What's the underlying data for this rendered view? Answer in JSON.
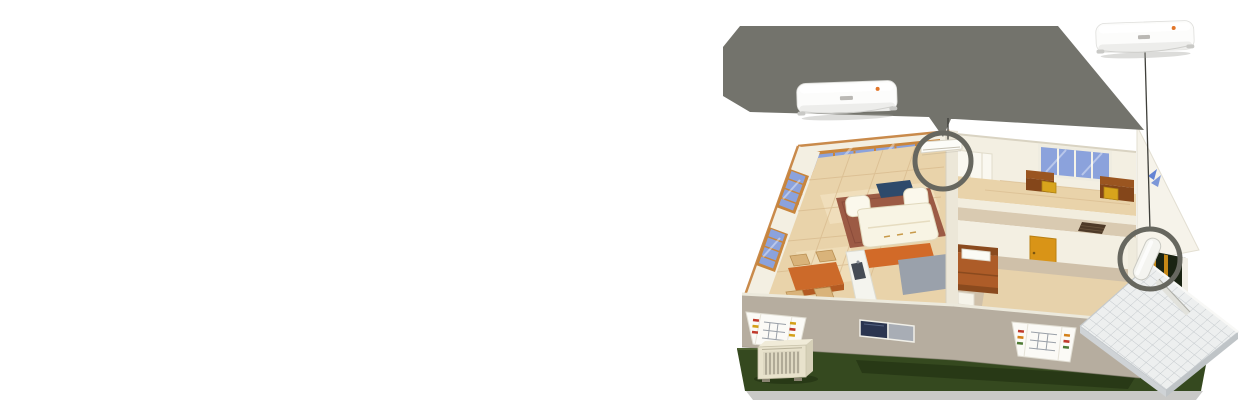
{
  "illustration": {
    "name": "multi-split-air-conditioner-home-installation",
    "components": {
      "enlarged_indoor_unit_left": "wall-mounted-split-indoor-unit",
      "enlarged_indoor_unit_right": "wall-mounted-split-indoor-unit",
      "callout_left": "indoor-unit-mounting-location",
      "callout_right": "piping-connection-location",
      "outdoor_unit": "outdoor-condenser-unit",
      "rooms": [
        "living-room-kitchen",
        "study-room",
        "hallway",
        "bedroom",
        "entry-porch"
      ]
    }
  },
  "palette": {
    "page_bg": "#ffffff",
    "beam_gray": "#73736c",
    "callout_ring": "#67675f",
    "connector_line": "#3f3f3a",
    "ac_body": "#fcfcfb",
    "ac_vent": "#ededeb",
    "ac_logo": "#b3b0ac",
    "indicator_orange": "#e2762a",
    "lawn_green": "#35491f",
    "lawn_shadow": "#1b2a0e",
    "base_strip": "#c9c9c7",
    "front_wall": "#b6ad9f",
    "wall_cream": "#f3efe2",
    "wall_trim": "#c98a4b",
    "partition_wall": "#ece7d8",
    "floor_tan": "#e9d3aa",
    "floor_light": "#f6e8c9",
    "window_blue": "#8ba2dc",
    "window_frame": "#c8853c",
    "study_window_frame": "#efece0",
    "rug_brick": "#9c5a44",
    "sofa_cream": "#f8f4e4",
    "tv_navy": "#2e4a6b",
    "dining_orange": "#cc6a2a",
    "chair_tan": "#d9b37a",
    "counter_orange": "#d26a28",
    "counter_gray": "#9aa1ab",
    "island_white": "#f4f4ee",
    "desk_brown": "#9a5520",
    "chair_yellow": "#d8a41c",
    "door_amber": "#d99417",
    "bed_brown": "#ad5c28",
    "pillow_white": "#fbfbf5",
    "bedroom_floor": "#cfc0a9",
    "bedroom_rug": "#e7d2ab",
    "corridor_floor": "#d9cab1",
    "vent_brown": "#4e3a28",
    "closet_white": "#faf8f0",
    "gable_white": "#f6f3ea",
    "emblem_blue": "#4a6fd0",
    "doorway_dark": "#1a2312",
    "porch_tile": "#edefef",
    "porch_grid": "#c3c8cc",
    "outdoor_unit_body": "#e8e2cc",
    "outdoor_unit_grille": "#6a6456",
    "basement_navy": "#2b3550",
    "basement_gray": "#a8adb5",
    "bay_white": "#fbfaf6"
  }
}
